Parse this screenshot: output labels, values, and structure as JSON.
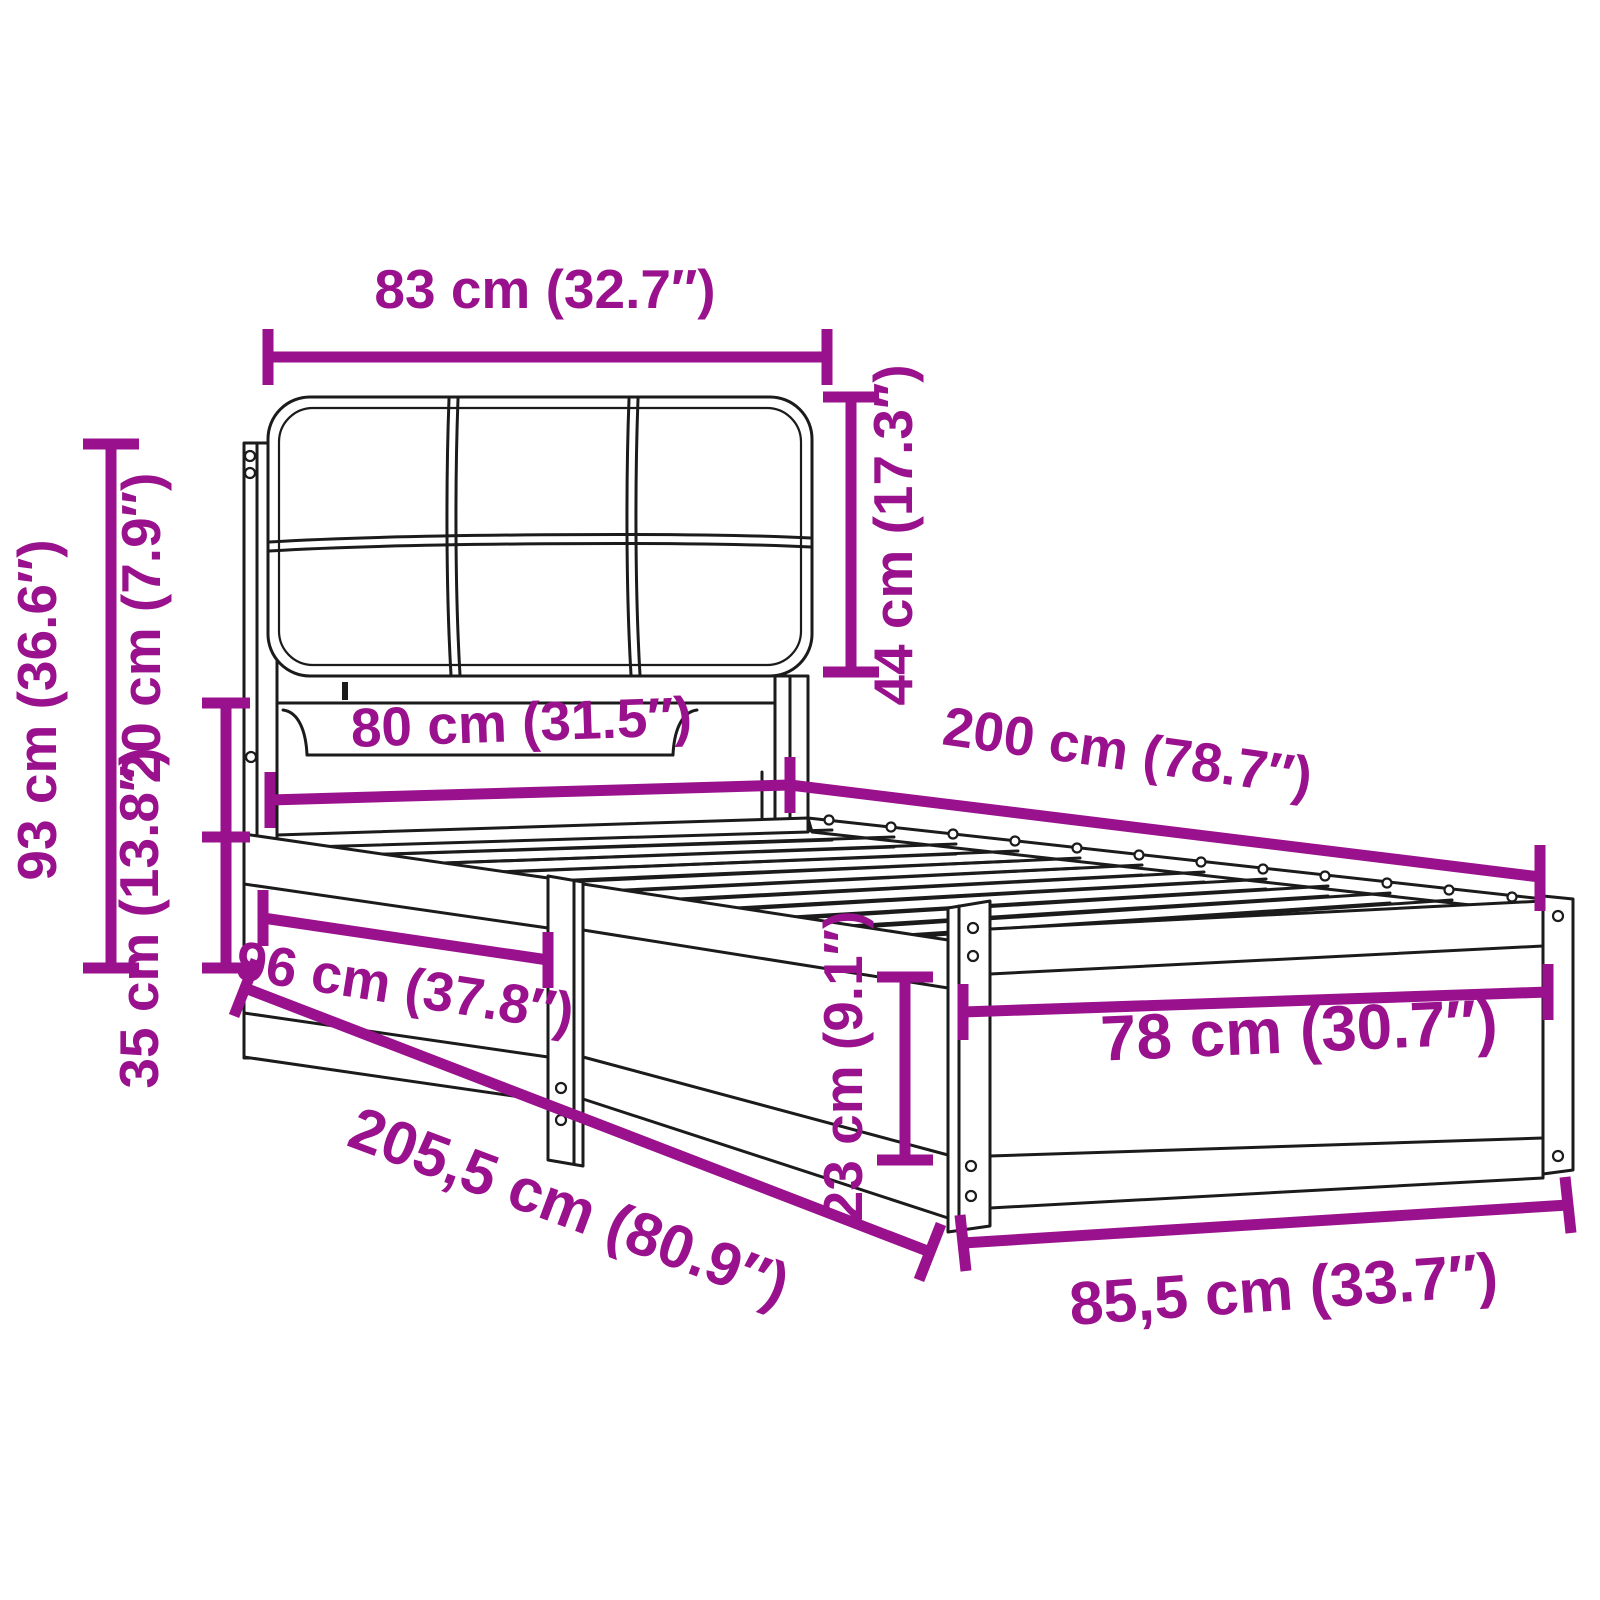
{
  "page": {
    "background": "#ffffff",
    "description": "Dimension diagram of a wooden bed frame with upholstered headboard cushion and slatted base"
  },
  "diagram": {
    "accent_color": "#99118c",
    "line_color": "#1b1b1b",
    "labels": {
      "headboard_width": "83 cm (32.7″)",
      "cushion_height": "44 cm (17.3″)",
      "total_height": "93 cm (36.6″)",
      "headboard_clearance": "20 cm (7.9″)",
      "base_height": "35 cm (13.8″)",
      "side_section_length": "96 cm (37.8″)",
      "mattress_width": "80 cm (31.5″)",
      "mattress_length": "200 cm (78.7″)",
      "footboard_inner_width": "78 cm (30.7″)",
      "foot_rail_height": "23 cm (9.1″)",
      "total_length": "205,5 cm (80.9″)",
      "total_width": "85,5 cm (33.7″)"
    }
  }
}
